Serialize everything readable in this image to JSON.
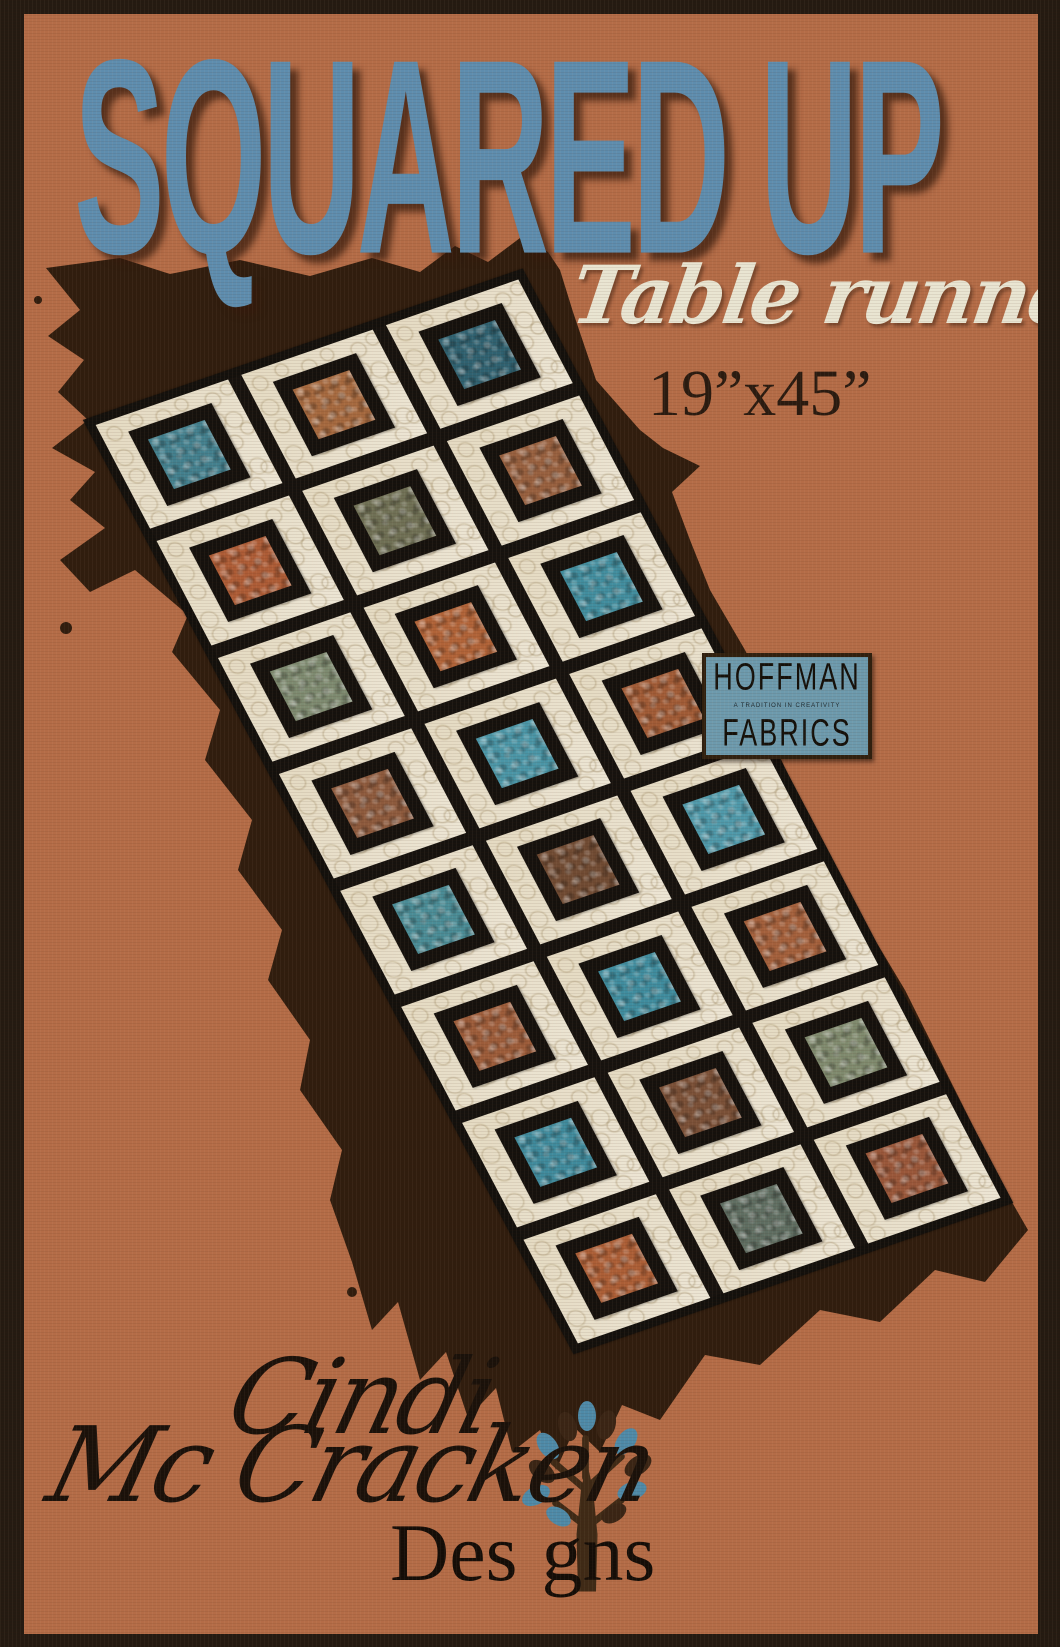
{
  "poster": {
    "title": "SQUARED UP",
    "subtitle": "Table runner",
    "size_label": "19”x45”",
    "colors": {
      "background_terracotta": "#b46c47",
      "frame_brown": "#241a11",
      "title_blue": "#5e8dae",
      "subtitle_cream": "#e9e5d2",
      "brush_shadow_brown": "#301d0e"
    }
  },
  "hoffman_label": {
    "name": "HOFFMAN",
    "tagline": "A TRADITION IN CREATIVITY",
    "word_fabrics": "FABRICS",
    "colors": {
      "label_blue": "#6d9aad",
      "text_black": "#14100a"
    }
  },
  "designer": {
    "first_name": "Cindi",
    "last_name": "Mc Cracken",
    "designs_word": "Designs",
    "designs_left": "Des",
    "designs_right": "gns",
    "colors": {
      "script_black": "#1a110a",
      "leaf_blue": "#4e8aa8",
      "leaf_brown": "#3a2515",
      "trunk_brown": "#3f2a16"
    }
  },
  "quilt": {
    "rows": 8,
    "cols": 3,
    "fabric_cream": "#e9e1cd",
    "sashing_black": "#16120e",
    "binding_black": "#13100c",
    "center_colors": [
      [
        "#43808e",
        "#a5693f",
        "#2f6170"
      ],
      [
        "#ad5c36",
        "#6f7055",
        "#97603f"
      ],
      [
        "#7d8a70",
        "#b06338",
        "#418d9e"
      ],
      [
        "#8d5a3d",
        "#4a95a6",
        "#a05b36"
      ],
      [
        "#4a8c96",
        "#704b33",
        "#4f99aa"
      ],
      [
        "#9c5c3a",
        "#3f8c9e",
        "#a3603c"
      ],
      [
        "#3f8a9c",
        "#7a5037",
        "#7f8a6e"
      ],
      [
        "#ab5e36",
        "#5f6e62",
        "#99573a"
      ]
    ]
  }
}
